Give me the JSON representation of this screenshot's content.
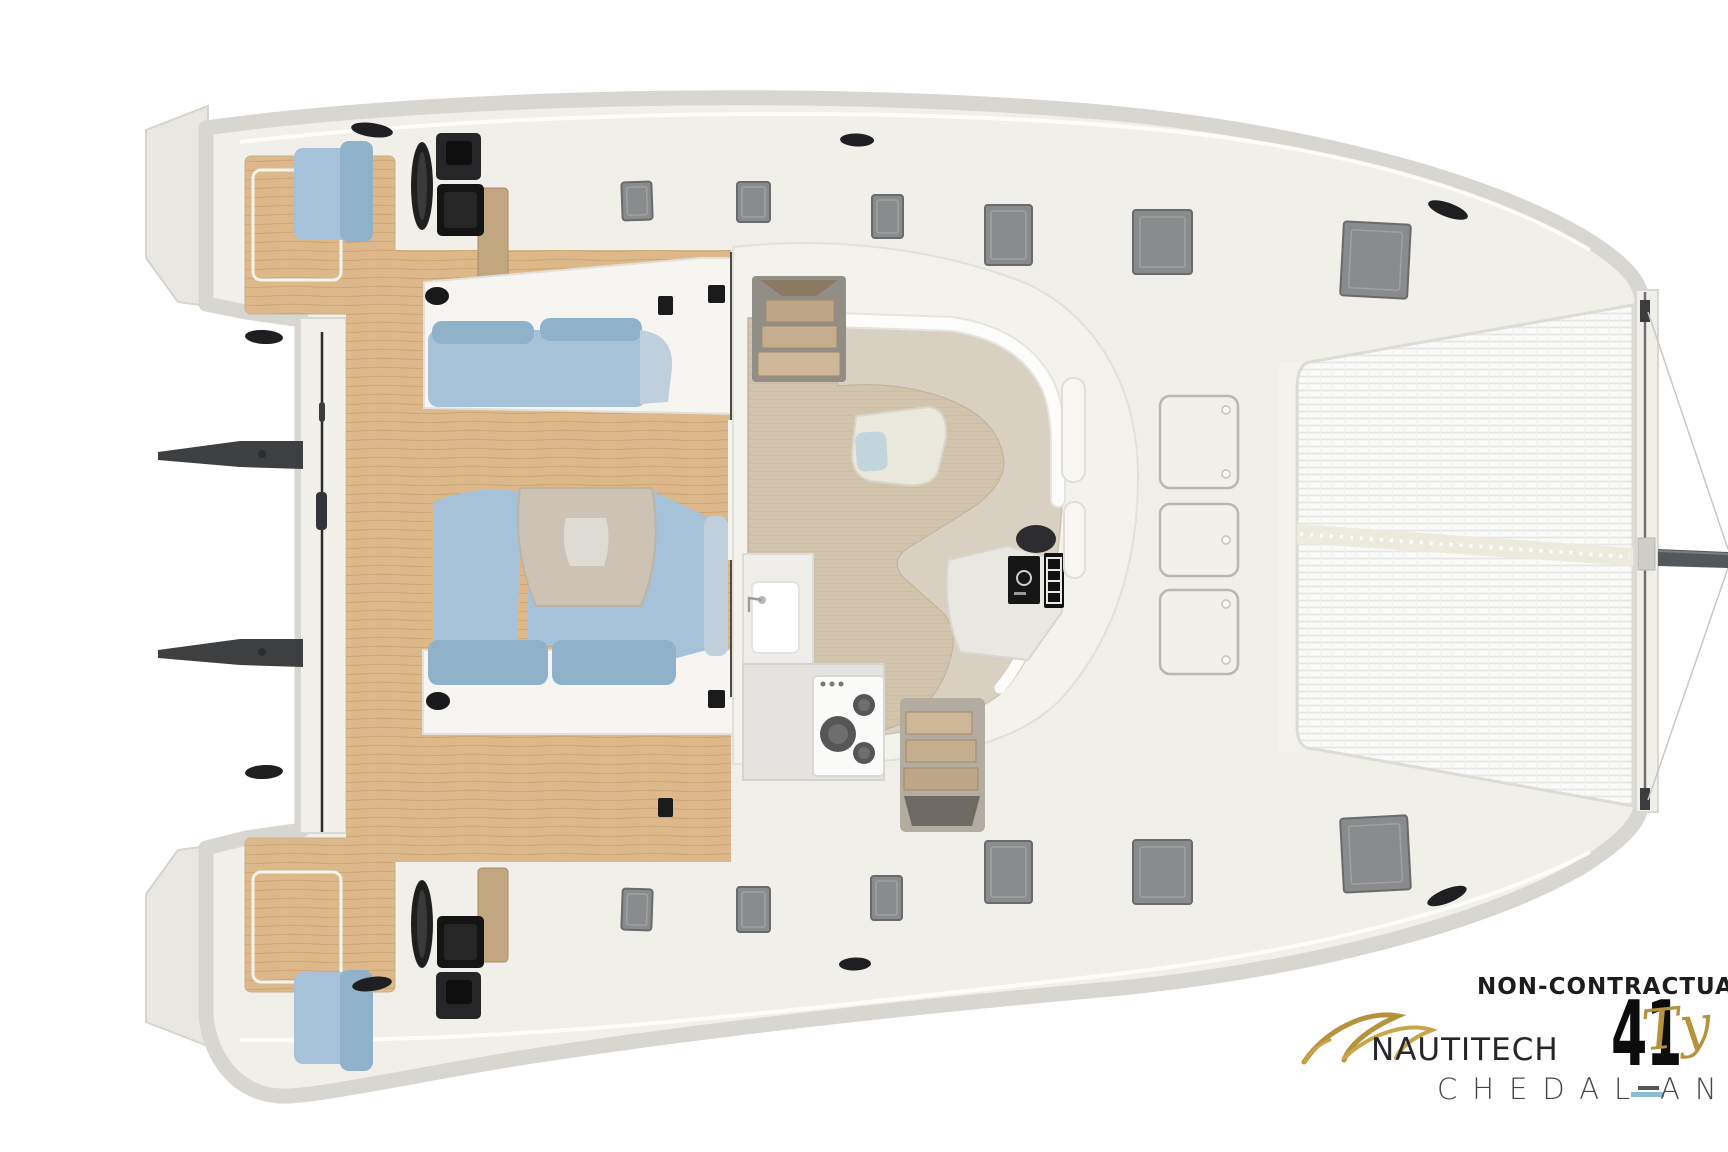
{
  "logo": {
    "disclaimer": "NON-CONTRACTUAL",
    "brand": "NAUTITECH",
    "model": "41",
    "model_script": "Ty",
    "designer_left": "CHEDAL",
    "designer_dash": "-",
    "designer_right": "ANG"
  },
  "palette": {
    "white": "#ffffff",
    "deck": "#f1efe9",
    "band": "#d8d6d0",
    "deckline": "#e3e1db",
    "teak": "#dcb88a",
    "teakline": "#c19058",
    "cushion": "#a6c2d8",
    "cushion_dark": "#8fb2ca",
    "cushion_pale": "#bfd0dc",
    "sofabase": "#f6f5f2",
    "cockpit_table": "#ccc3b4",
    "cockpit_table_inset": "#dedcd2",
    "floor": "#d2c3ac",
    "floorline": "#c0ae94",
    "settee": "#d8d1c2",
    "cap_white": "#fcfcfb",
    "saloon_table": "#eae7dd",
    "saloon_table_inset": "#c2d5dd",
    "counter": "#efeeea",
    "counter_gray": "#e4e3df",
    "stove": "#fbfbfa",
    "burner": "#565656",
    "wood": "#c2a67f",
    "wood_dark": "#a38a66",
    "stepgray": "#918e88",
    "hatch": "#898b8d",
    "hatch_edge": "#686a6c",
    "hatch_inner": "#9fa1a3",
    "black": "#1f1f21",
    "helm": "#262628",
    "tramp": "#fafaf9",
    "tramp_line": "#e5e5e3",
    "tramp_strip": "#edeade",
    "beam": "#f1efe9",
    "beam_line": "#707072",
    "pole": "#55585b",
    "gold": "#b5923c",
    "gold_light": "#c9a54a",
    "ink": "#1c1d1f",
    "designer": "#45464c",
    "dash_blue": "#8cbcd2"
  }
}
